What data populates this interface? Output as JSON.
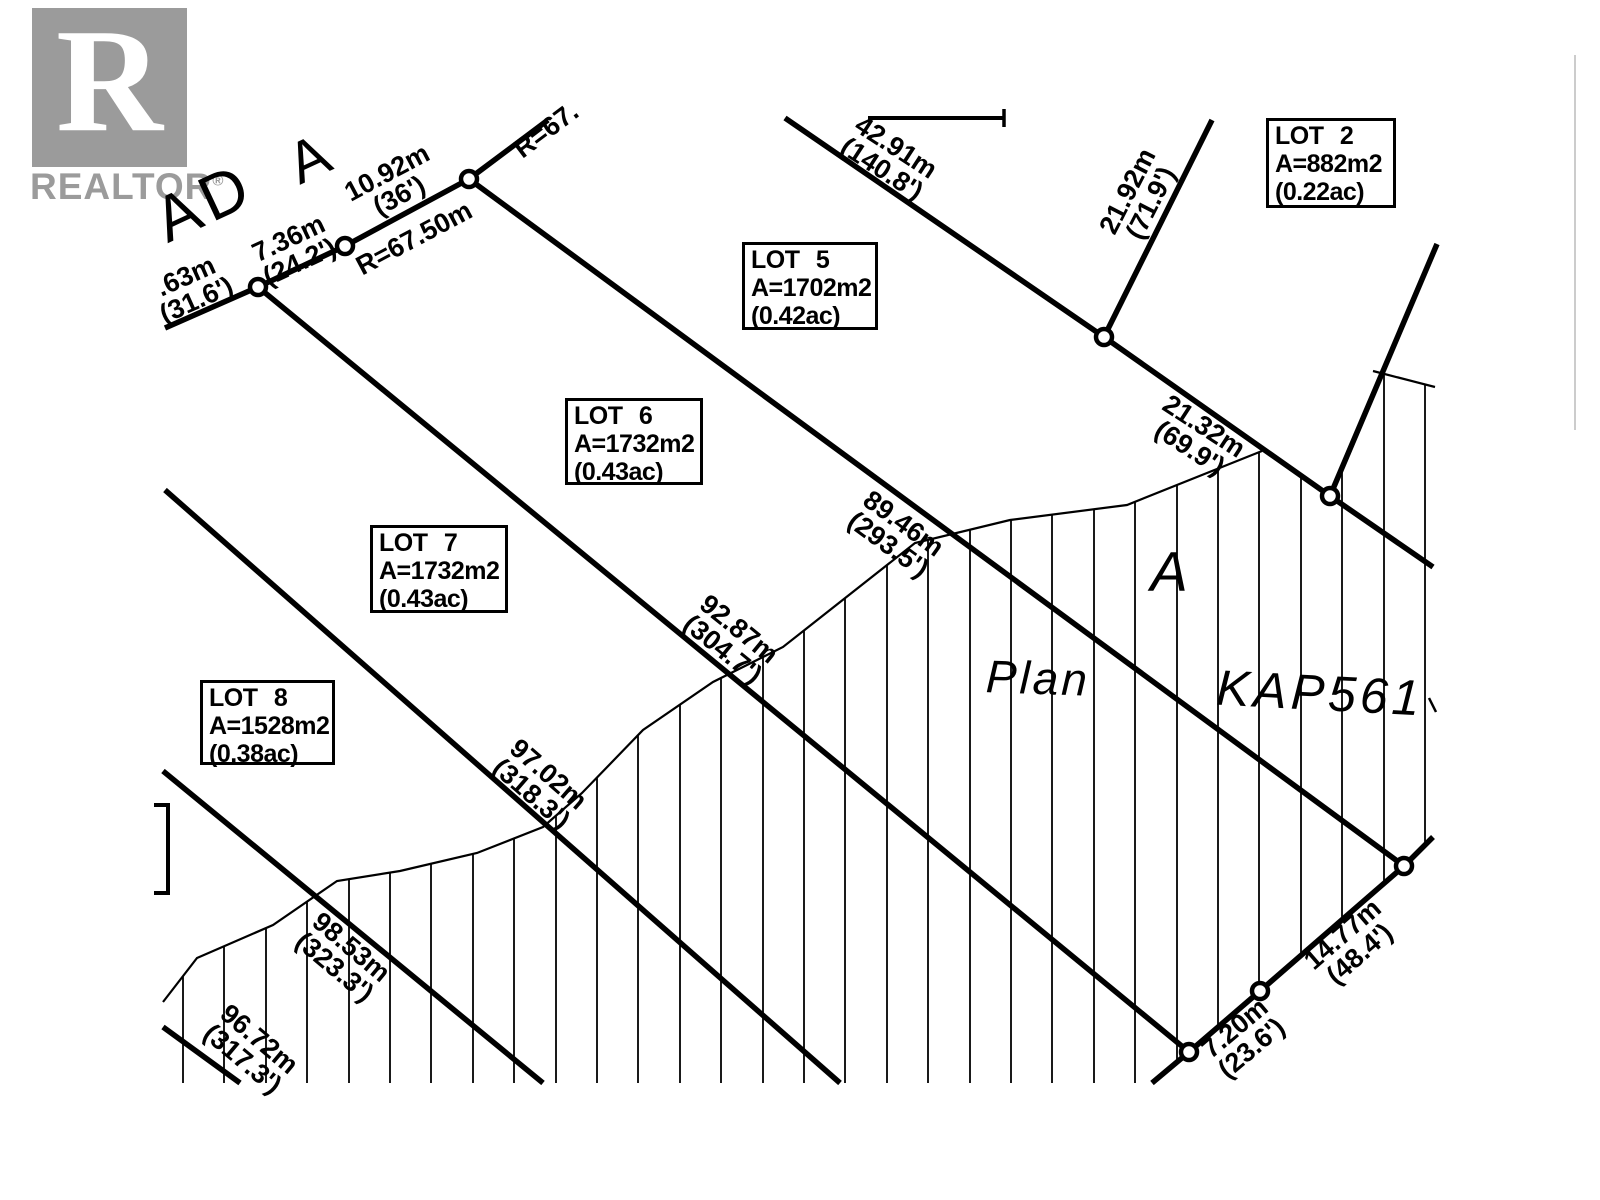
{
  "watermark": {
    "logo_letter": "R",
    "brand": "REALTOR",
    "registered_mark": "®"
  },
  "road_labels": {
    "name_fragment": "AD",
    "name_letter": "A"
  },
  "plan_labels": {
    "plan_word": "Plan",
    "plan_number": "KAP561",
    "area_letter": "A"
  },
  "lot_boxes": [
    {
      "title": "LOT 2",
      "area": "A=882m2",
      "acreage": "(0.22ac)"
    },
    {
      "title": "LOT 5",
      "area": "A=1702m2",
      "acreage": "(0.42ac)"
    },
    {
      "title": "LOT 6",
      "area": "A=1732m2",
      "acreage": "(0.43ac)"
    },
    {
      "title": "LOT 7",
      "area": "A=1732m2",
      "acreage": "(0.43ac)"
    },
    {
      "title": "LOT 8",
      "area": "A=1528m2",
      "acreage": "(0.38ac)"
    }
  ],
  "dimensions": {
    "road_seg_left": {
      "metric": ".63m",
      "imperial": "(31.6')"
    },
    "road_seg_mid": {
      "metric": "7.36m",
      "imperial": "(24.2')"
    },
    "road_seg_right": {
      "metric": "10.92m",
      "imperial": "(36')"
    },
    "road_radius": {
      "label": "R=67.50m"
    },
    "road_radius_top": {
      "label": "R=67."
    },
    "lot2_north": {
      "metric": "42.91m",
      "imperial": "(140.8')"
    },
    "lot2_west": {
      "metric": "21.92m",
      "imperial": "(71.9')"
    },
    "lot2_south": {
      "metric": "21.32m",
      "imperial": "(69.9')"
    },
    "lot5_east": {
      "metric": "89.46m",
      "imperial": "(293.5')"
    },
    "lot6_east": {
      "metric": "92.87m",
      "imperial": "(304.7')"
    },
    "lot7_east": {
      "metric": "97.02m",
      "imperial": "(318.3')"
    },
    "lot8_east": {
      "metric": "98.53m",
      "imperial": "(323.3')"
    },
    "lot9_east": {
      "metric": "96.72m",
      "imperial": "(317.3')"
    },
    "rear_seg_short": {
      "metric": "7.20m",
      "imperial": "(23.6')"
    },
    "rear_seg_long": {
      "metric": "14.77m",
      "imperial": "(48.4')"
    }
  }
}
